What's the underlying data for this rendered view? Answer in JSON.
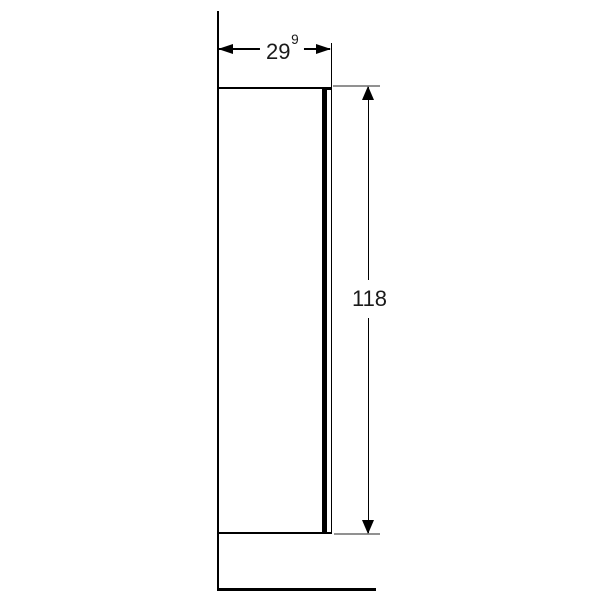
{
  "drawing": {
    "width_dimension": {
      "value": "29",
      "superscript": "9"
    },
    "height_dimension": {
      "value": "118"
    },
    "colors": {
      "background": "#ffffff",
      "line": "#000000",
      "extension_line": "#919191",
      "text": "#1a1a1a"
    }
  }
}
